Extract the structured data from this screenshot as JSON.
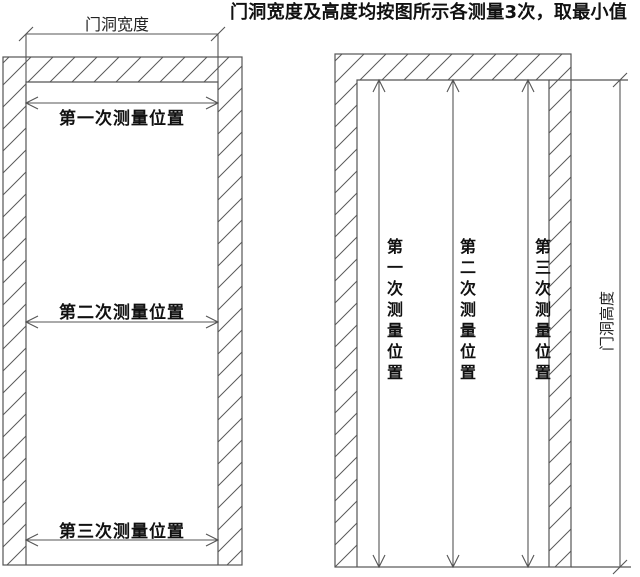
{
  "title": "门洞宽度及高度均按图所示各测量3次，取最小值",
  "left_diagram": {
    "name": "door-opening-width-measurement",
    "dimension_label": "门洞宽度",
    "measurements": [
      {
        "label": "第一次测量位置"
      },
      {
        "label": "第二次测量位置"
      },
      {
        "label": "第三次测量位置"
      }
    ]
  },
  "right_diagram": {
    "name": "door-opening-height-measurement",
    "dimension_label": "门洞高度",
    "measurements": [
      {
        "label": "第一次测量位置"
      },
      {
        "label": "第二次测量位置"
      },
      {
        "label": "第三次测量位置"
      }
    ]
  },
  "colors": {
    "line": "#555555",
    "text": "#111111",
    "background": "#ffffff"
  }
}
